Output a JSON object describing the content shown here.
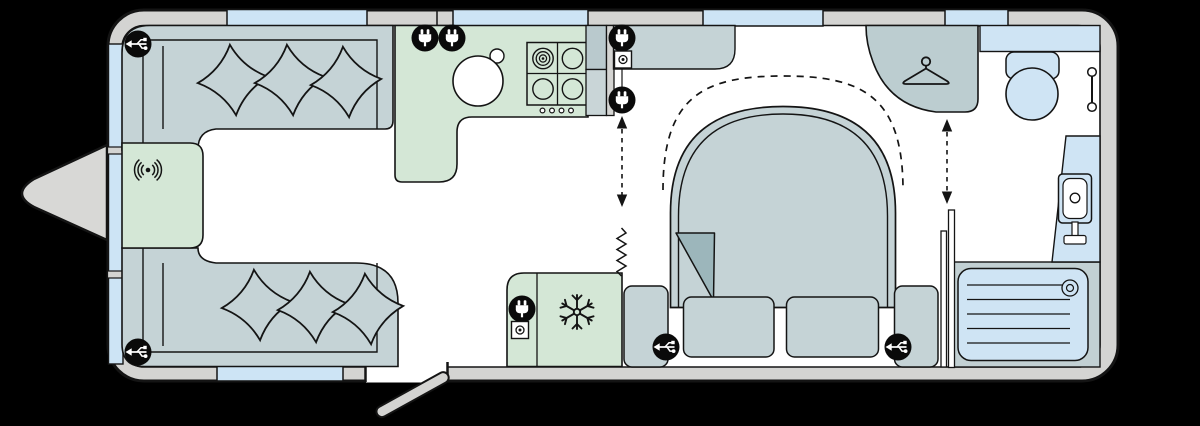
{
  "title": "caravan-floorplan",
  "colors": {
    "bg": "#000000",
    "line": "#141414",
    "wall": "#d4d4d2",
    "floor": "#ffffff",
    "window": "#cde4f5",
    "sofa": "#c5d3d6",
    "green": "#d4e7d6",
    "bed": "#c5d3d6",
    "fold": "#9cb6bb",
    "wash": "#c2d0d3",
    "wardrobe": "#bccdd0",
    "fixture": "#cfe4f4",
    "cupboardA": "#b9c9cd",
    "cupboardB": "#c9d5d7",
    "hitch": "#d8d8d6",
    "iconBlack": "#0a0a0a",
    "iconWhite": "#ffffff"
  },
  "icons": [
    "usb-socket-icon",
    "mains-socket-icon",
    "tv-aerial-socket-icon",
    "wireless-charging-icon",
    "freezer-snowflake-icon",
    "clothes-hanger-icon"
  ],
  "icon_counts": {
    "usb_sockets": 4,
    "mains_sockets": 5,
    "tv_aerial_sockets": 2,
    "wireless_charging_pads": 1
  },
  "rooms": {
    "lounge": {
      "fixtures": [
        "u-shaped-sofa",
        "six-scatter-cushions",
        "front-chest-with-wireless-charging"
      ]
    },
    "kitchen": {
      "fixtures": [
        "round-sink-with-tap",
        "four-burner-hob-with-knobs",
        "l-shaped-worktop",
        "tall-cupboard"
      ]
    },
    "galley": {
      "fixtures": [
        "fridge-freezer",
        "concertina-divider"
      ]
    },
    "bedroom": {
      "fixtures": [
        "island-bed-with-turned-corner",
        "two-bed-drawers",
        "two-bedside-units",
        "overhead-locker",
        "wardrobe",
        "bed-extension-dashed-arc"
      ]
    },
    "washroom": {
      "fixtures": [
        "toilet-with-cistern",
        "vanity-basin-with-tap",
        "shower-tray-with-drain",
        "towel-rail",
        "sliding-partition-door"
      ]
    }
  },
  "exterior": {
    "features": [
      "a-frame-hitch",
      "entry-door-open",
      "front-window-three-pane",
      "four-top-windows",
      "one-bottom-window"
    ]
  },
  "annotations": {
    "dashed_double_arrows": 2,
    "dashed_bed_arc": 1
  }
}
